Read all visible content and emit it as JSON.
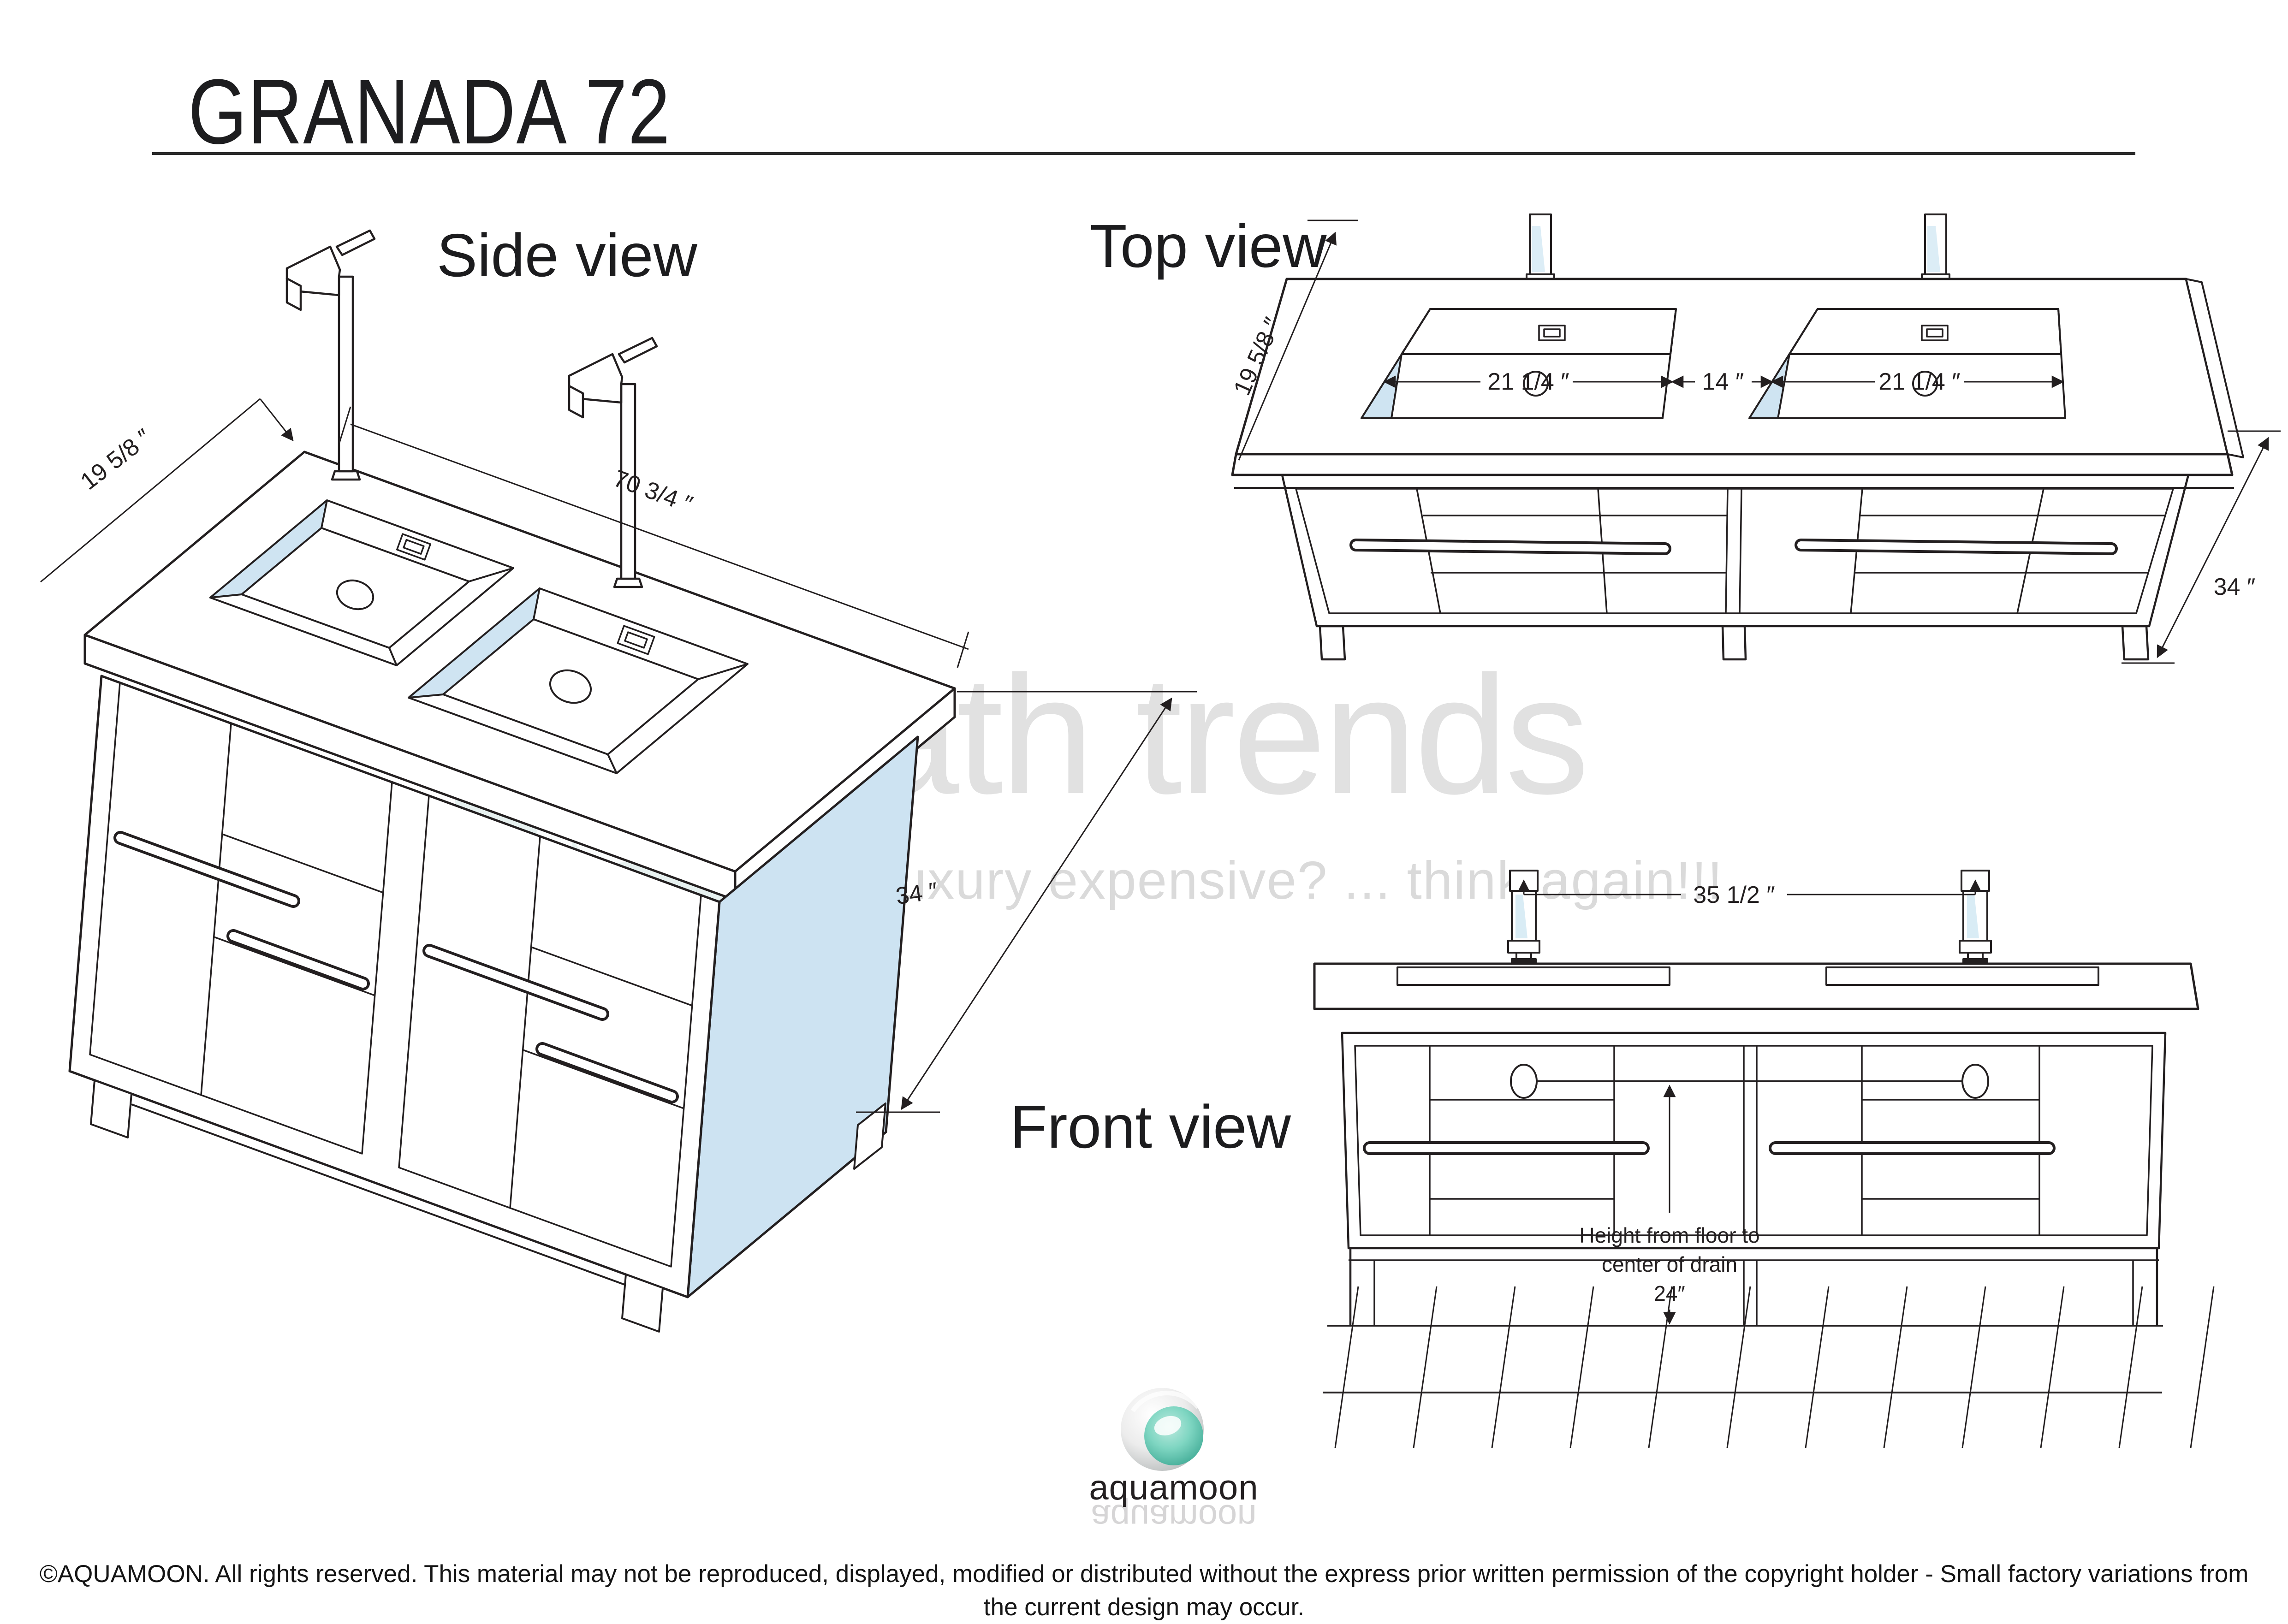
{
  "title": "GRANADA 72",
  "views": {
    "side": {
      "label": "Side view",
      "dim_depth": "19 5/8 ″",
      "dim_width": "70 3/4 ″",
      "dim_height": "34 ″"
    },
    "top": {
      "label": "Top view",
      "dim_depth": "19 5/8 ″",
      "dim_sink_left": "21 1/4 ″",
      "dim_between": "14 ″",
      "dim_sink_right": "21 1/4 ″",
      "dim_height": "34 ″"
    },
    "front": {
      "label": "Front view",
      "dim_faucet_spacing": "35 1/2 ″",
      "drain_note_1": "Height from floor to",
      "drain_note_2": "center of drain",
      "drain_note_3": "24″"
    }
  },
  "watermark": {
    "monogram": "bt",
    "brand": "bath trends",
    "tagline": "is luxury expensive? ... think again!!!"
  },
  "logo": {
    "brand": "aquamoon"
  },
  "footer": {
    "line1": "©AQUAMOON. All rights reserved. This material may not be reproduced, displayed, modified or distributed without the express prior written permission of the copyright holder - Small factory variations from",
    "line2": "the current design may occur."
  },
  "colors": {
    "line": "#231f20",
    "sink_blue": "#cfe4f2",
    "panel_blue": "#cde3f2",
    "watermark_gray": "#e1e1e1",
    "watermark_teal": "#e7f1f0",
    "logo_teal": "#5cc2b1"
  }
}
